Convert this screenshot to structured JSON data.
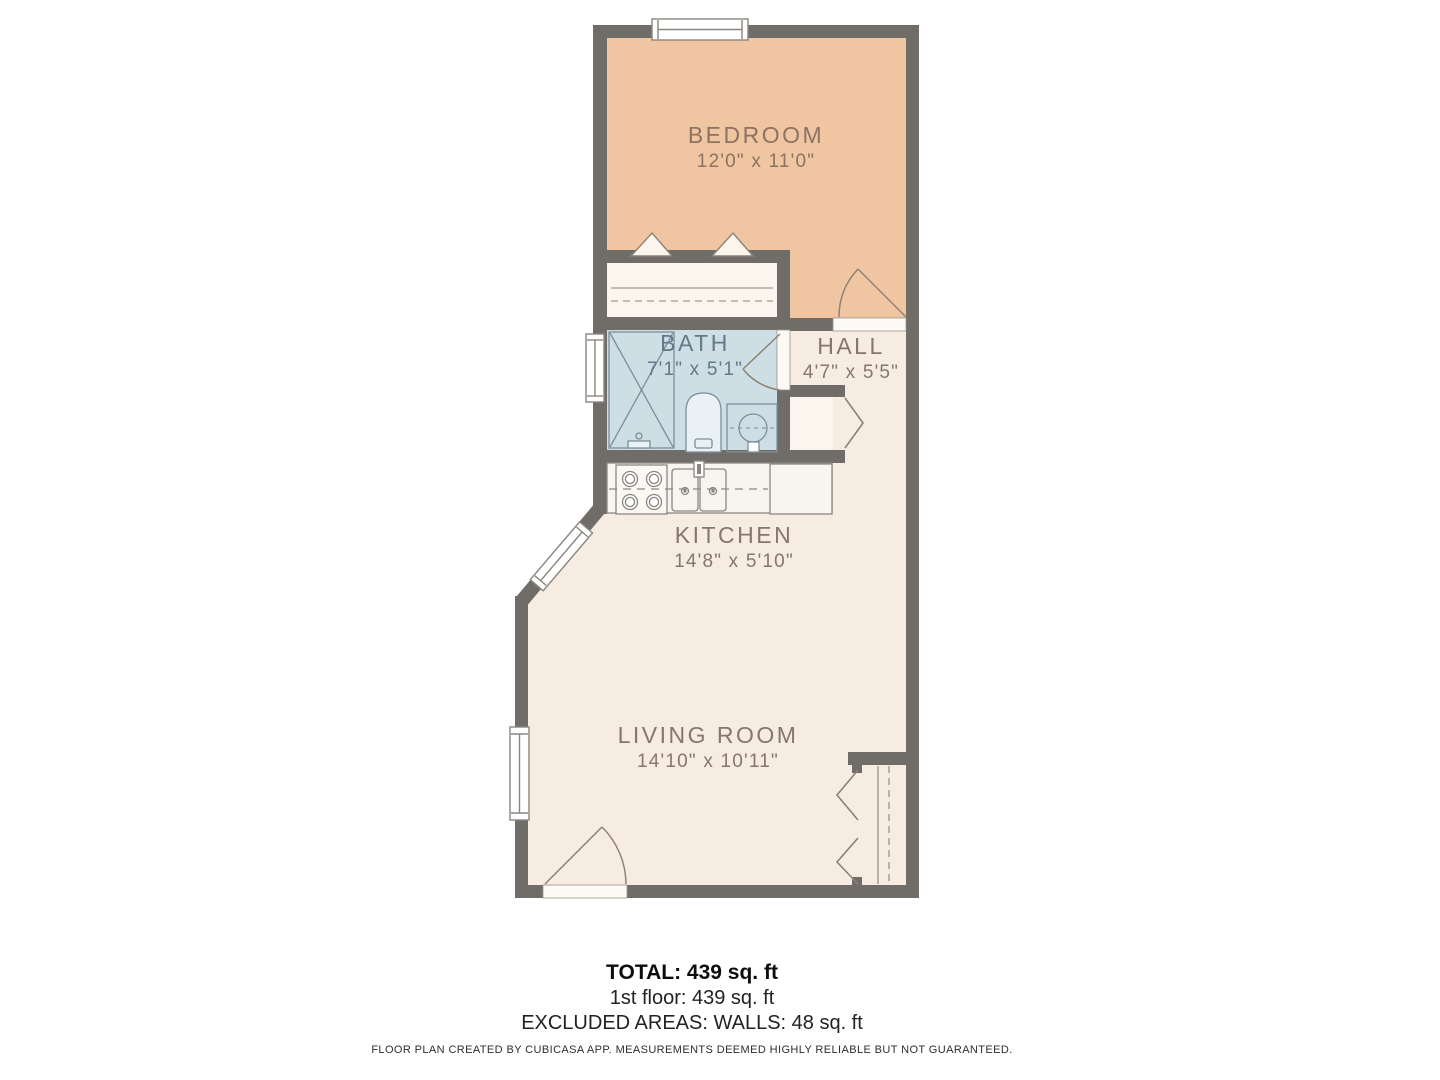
{
  "plan": {
    "title": "1st floor plan",
    "rooms": [
      {
        "id": "bedroom",
        "name": "BEDROOM",
        "dims": "12'0\" x 11'0\""
      },
      {
        "id": "bath",
        "name": "BATH",
        "dims": "7'1\" x 5'1\""
      },
      {
        "id": "hall",
        "name": "HALL",
        "dims": "4'7\" x 5'5\""
      },
      {
        "id": "kitchen",
        "name": "KITCHEN",
        "dims": "14'8\" x 5'10\""
      },
      {
        "id": "living_room",
        "name": "LIVING ROOM",
        "dims": "14'10\" x 10'11\""
      }
    ],
    "fixtures": [
      "shower",
      "toilet",
      "bathroom-sink",
      "stove",
      "kitchen-sink",
      "counter",
      "closet-bifold-doors",
      "hanging-rods",
      "windows",
      "doors"
    ]
  },
  "summary": {
    "total": "TOTAL: 439 sq. ft",
    "floor1": "1st floor: 439 sq. ft",
    "excluded": "EXCLUDED AREAS: WALLS: 48 sq. ft"
  },
  "footer": "FLOOR PLAN CREATED BY CUBICASA APP. MEASUREMENTS DEEMED HIGHLY RELIABLE BUT NOT GUARANTEED.",
  "colors": {
    "wall": "#706d69",
    "bedroom_fill": "#efc5a2",
    "bath_fill": "#cedee5",
    "floor_fill": "#f6ece2",
    "closet_fill": "#fbf5ed",
    "fixture_stroke": "#8a8781",
    "bath_fixture_stroke": "#7f8e97",
    "door_stroke": "#8f8276",
    "label_bedroom": "#8d7361",
    "label_bath": "#63798a",
    "label_neutral": "#84786b"
  }
}
